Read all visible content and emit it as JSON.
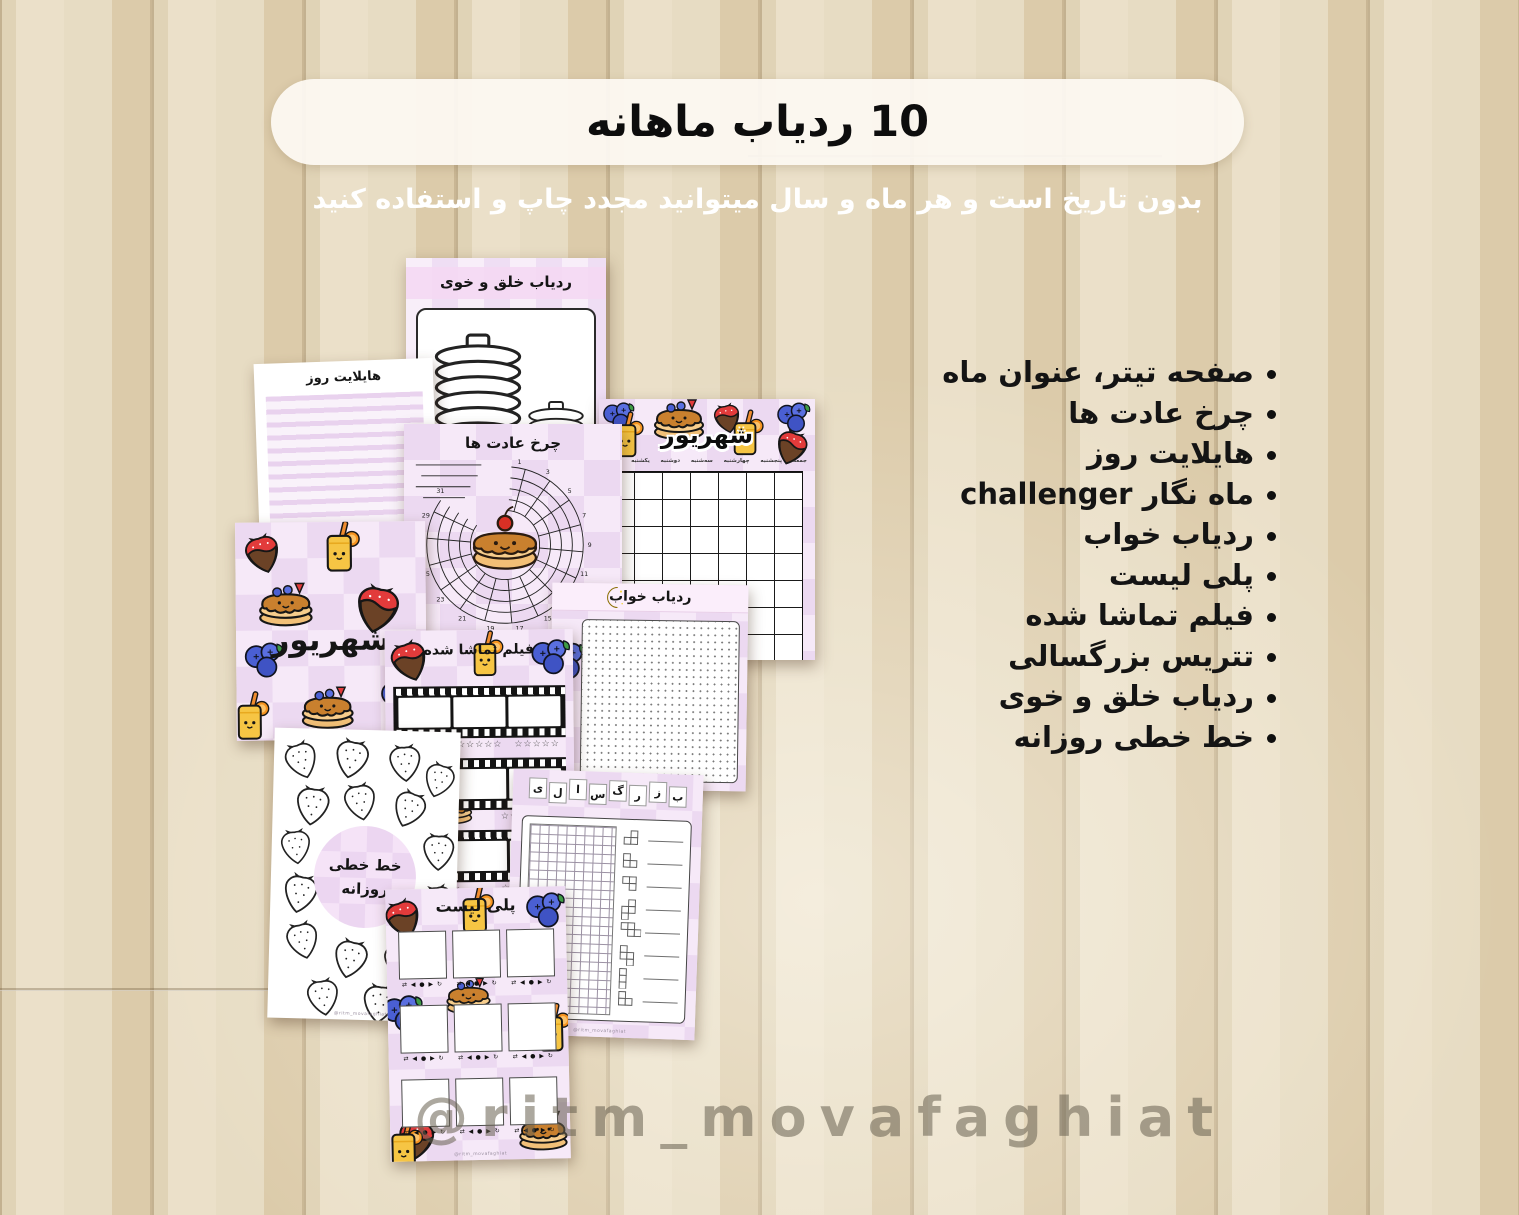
{
  "header": {
    "title": "10 ردیاب ماهانه",
    "subtitle": "بدون تاریخ است و هر ماه و سال میتوانید مجدد چاپ و استفاده کنید"
  },
  "features": {
    "items": [
      {
        "label": "صفحه تیتر، عنوان ماه"
      },
      {
        "label": "چرخ عادت ها"
      },
      {
        "label": "هایلایت روز"
      },
      {
        "label": "ماه نگار challenger"
      },
      {
        "label": "ردیاب خواب"
      },
      {
        "label": "پلی لیست"
      },
      {
        "label": "فیلم تماشا شده"
      },
      {
        "label": "تتریس بزرگسالی"
      },
      {
        "label": "ردیاب خلق و خوی"
      },
      {
        "label": "خط خطی روزانه"
      }
    ]
  },
  "watermark": {
    "handle": "@ritm_movafaghiat"
  },
  "pages": {
    "page_watermark": "@ritm_movafaghiat",
    "mood_tracker": {
      "title": "ردیاب خلق و خوی"
    },
    "day_highlight": {
      "title": "هایلایت روز"
    },
    "habit_wheel": {
      "title": "چرخ عادت ها",
      "day_numbers": "1-31",
      "ticks": [
        "1",
        "3",
        "5",
        "7",
        "9",
        "11",
        "13",
        "15",
        "17",
        "19",
        "21",
        "23",
        "25",
        "27",
        "29",
        "31"
      ]
    },
    "month_chart": {
      "title": "شهریور",
      "day_labels": [
        "شنبه",
        "یکشنبه",
        "دوشنبه",
        "سه‌شنبه",
        "چهارشنبه",
        "پنجشنبه",
        "جمعه"
      ]
    },
    "month_cover": {
      "title": "شهریور"
    },
    "sleep_tracker": {
      "title": "ردیاب خواب"
    },
    "watched_movies": {
      "title": "فیلم تماشا شده",
      "stars": "☆☆☆☆☆"
    },
    "adult_tetris": {
      "letters": [
        "ب",
        "ز",
        "ر",
        "گ",
        "س",
        "ا",
        "ل",
        "ی"
      ]
    },
    "daily_doodle": {
      "title_line1": "خط خطی",
      "title_line2": "روزانه"
    },
    "playlist": {
      "title": "پلی لیست",
      "controls": "⇄ ◀ ● ▶ ↻"
    }
  },
  "icons": {
    "bullet": "round-dot",
    "moon": "crescent-moon",
    "strawberry": "chocolate-dipped-strawberry",
    "blueberries": "blueberry-cluster",
    "juice": "orange-juice-glass",
    "pancakes": "pancake-stack",
    "player_controls": "⇄ ◀ ● ▶ ↻",
    "star": "☆"
  },
  "colors": {
    "wood_light": "#ebe0c9",
    "wood_dark": "#c9b694",
    "pill_bg": "#fcf8f1",
    "subtitle_text": "#ffffff",
    "list_text": "#141414",
    "page_pink_light": "#f6e9f8",
    "page_pink_dark": "#ecd9f1",
    "header_band_pink": "#f4d8f3",
    "watermark_gray": "#686050",
    "strawberry_red": "#e23b3b",
    "chocolate_brown": "#6b4226",
    "blueberry_blue": "#4a5fd3",
    "juice_yellow": "#f6c544",
    "pancake_tan": "#f3bf76",
    "syrup_brown": "#c9802e",
    "moon_yellow": "#f3d23f"
  }
}
